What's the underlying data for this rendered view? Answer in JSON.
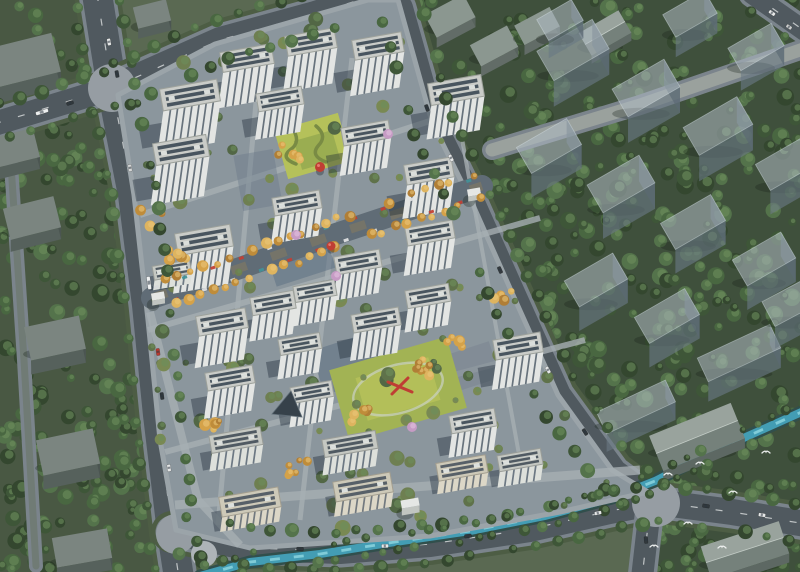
{
  "canvas": {
    "w": 800,
    "h": 572
  },
  "palette": {
    "ground_base": "#57654e",
    "forest": {
      "right": "#3b4b37",
      "left": "#45543e"
    },
    "road": {
      "verge": "#49593f",
      "bed": "#79828a",
      "asphalt": "#4c555b",
      "dash": "#e8eaea",
      "plaza": "#959ca2"
    },
    "canal": {
      "bank": "#2c4a47",
      "water": "#3f9cb3",
      "core": "#8fd8e2"
    },
    "compound": {
      "ground": "#8a949c",
      "edge": "#9ba3a8",
      "path": "#a6aeb2",
      "lawn": "#b6c156",
      "lawn2": "#8fa24a",
      "park": "#a2b250",
      "ring": "#ccd2c4",
      "axis": "#5d6973",
      "board": "#8a7a58"
    },
    "slab": {
      "t": {
        "roof": "#cbcdc8",
        "edge": "#9da09a",
        "panel": "#3a4651",
        "face": "#e5e7e4",
        "win": "#4e5b67"
      },
      "m": {
        "roof": "#c6c8c2",
        "edge": "#999c96",
        "panel": "#414c56",
        "face": "#dfe1dc",
        "win": "#566371"
      },
      "s": {
        "roof": "#cfc9b8",
        "edge": "#a39d8d",
        "panel": "#4a535c",
        "face": "#ded8c7",
        "win": "#5d6670"
      }
    },
    "ghost": {
      "top": "rgba(174,186,194,0.55)",
      "front": "rgba(104,118,129,0.62)",
      "side": "rgba(88,101,112,0.66)",
      "stroke": "rgba(218,228,233,0.45)"
    },
    "opaque": {
      "roof": "#79837d",
      "front": "#535d58",
      "side": "#47514c"
    },
    "flat": {
      "roof": "#8a958e",
      "front": "#5f6963",
      "side": "#555f59"
    },
    "pitched": {
      "light": "#98a29c",
      "dark": "#737e78",
      "front": "#5a645f"
    },
    "trees": {
      "green": [
        "#2f4229",
        "#3a5232",
        "#45633c",
        "#517046"
      ],
      "green_hi": "#6b8c59",
      "compound_green": [
        "#4f6340",
        "#5c6f45",
        "#6c7c4c",
        "#77874f"
      ],
      "orange": [
        "#c08a35",
        "#d7a144",
        "#e0b45b",
        "#b07b30"
      ],
      "orange_hi": "#ecc676",
      "pink": "#c79ac4",
      "pink_hi": "#e4c2e1"
    },
    "accents": {
      "red": "#c0392e",
      "white": "#f2f3f3",
      "teal": "#3e8f96"
    },
    "bird": "#f4f6f4",
    "shadow": "rgba(18,32,46,0.38)"
  },
  "forest_zones": [
    {
      "poly": [
        [
          393,
          0
        ],
        [
          800,
          0
        ],
        [
          800,
          572
        ],
        [
          652,
          572
        ],
        [
          648,
          512
        ],
        [
          612,
          470
        ],
        [
          556,
          392
        ],
        [
          512,
          292
        ],
        [
          470,
          200
        ],
        [
          430,
          118
        ]
      ],
      "n": 400,
      "rmin": 4,
      "rmax": 9,
      "seed": 11,
      "base": "right"
    },
    {
      "poly": [
        [
          0,
          0
        ],
        [
          96,
          0
        ],
        [
          112,
          88
        ],
        [
          133,
          195
        ],
        [
          147,
          305
        ],
        [
          158,
          415
        ],
        [
          172,
          532
        ],
        [
          178,
          572
        ],
        [
          0,
          572
        ]
      ],
      "n": 220,
      "rmin": 4,
      "rmax": 9,
      "seed": 7,
      "base": "left"
    }
  ],
  "roads": [
    {
      "id": "left-avenue",
      "pts": [
        [
          97,
          -6
        ],
        [
          112,
          88
        ],
        [
          133,
          195
        ],
        [
          147,
          305
        ],
        [
          158,
          415
        ],
        [
          172,
          532
        ],
        [
          179,
          578
        ]
      ],
      "w": 30,
      "verge": true,
      "dash": true
    },
    {
      "id": "west-arm",
      "pts": [
        [
          -6,
          124
        ],
        [
          112,
          88
        ]
      ],
      "w": 24,
      "verge": true,
      "dash": true
    },
    {
      "id": "north-east-ring",
      "pts": [
        [
          112,
          88
        ],
        [
          220,
          40
        ],
        [
          315,
          14
        ],
        [
          372,
          -4
        ],
        [
          400,
          8
        ],
        [
          432,
          122
        ],
        [
          473,
          205
        ],
        [
          513,
          295
        ],
        [
          558,
          395
        ],
        [
          614,
          472
        ],
        [
          652,
          500
        ]
      ],
      "w": 26,
      "verge": true,
      "dash": true
    },
    {
      "id": "south-road",
      "pts": [
        [
          172,
          532
        ],
        [
          250,
          548
        ],
        [
          340,
          551
        ],
        [
          430,
          544
        ],
        [
          530,
          529
        ],
        [
          610,
          511
        ],
        [
          656,
          502
        ],
        [
          732,
          512
        ],
        [
          806,
          524
        ]
      ],
      "w": 26,
      "verge": true,
      "dash": true
    },
    {
      "id": "south-exit",
      "pts": [
        [
          650,
          508
        ],
        [
          642,
          578
        ]
      ],
      "w": 22,
      "verge": false,
      "dash": true
    },
    {
      "id": "corner-road",
      "pts": [
        [
          752,
          -6
        ],
        [
          806,
          32
        ]
      ],
      "w": 20,
      "verge": false,
      "dash": true
    },
    {
      "id": "forest-path",
      "pts": [
        [
          492,
          150
        ],
        [
          640,
          105
        ],
        [
          806,
          48
        ]
      ],
      "w": 13,
      "verge": false,
      "dash": false,
      "color": "#9aa09c"
    },
    {
      "id": "far-left-lane",
      "pts": [
        [
          10,
          150
        ],
        [
          24,
          360
        ],
        [
          36,
          566
        ]
      ],
      "w": 7,
      "verge": false,
      "dash": false,
      "color": "#6e7872"
    }
  ],
  "tree_lines": [
    {
      "road": 0,
      "offsets": [
        -23,
        23
      ],
      "step": 21
    },
    {
      "road": 1,
      "offsets": [
        -18,
        18
      ],
      "step": 22
    },
    {
      "road": 2,
      "offsets": [
        -21,
        21
      ],
      "step": 22
    },
    {
      "road": 3,
      "offsets": [
        -19,
        19
      ],
      "step": 22
    },
    {
      "road": 5,
      "offsets": [
        16
      ],
      "step": 20
    }
  ],
  "intersections": [
    [
      112,
      88,
      24
    ],
    [
      176,
      534,
      20
    ],
    [
      656,
      503,
      24
    ]
  ],
  "corner_plaza": [
    204,
    554,
    13
  ],
  "canal": {
    "pts": [
      [
        200,
        576
      ],
      [
        250,
        562
      ],
      [
        320,
        554
      ],
      [
        395,
        542
      ],
      [
        470,
        531
      ],
      [
        545,
        516
      ],
      [
        612,
        498
      ],
      [
        655,
        481
      ],
      [
        700,
        458
      ],
      [
        748,
        436
      ],
      [
        806,
        410
      ]
    ],
    "w": 8,
    "tree_offsets": [
      -8,
      9
    ],
    "step": 16
  },
  "compound": {
    "outline": [
      [
        118,
        95
      ],
      [
        215,
        44
      ],
      [
        312,
        16
      ],
      [
        368,
        0
      ],
      [
        398,
        0
      ],
      [
        432,
        122
      ],
      [
        473,
        205
      ],
      [
        513,
        295
      ],
      [
        558,
        395
      ],
      [
        612,
        470
      ],
      [
        648,
        492
      ],
      [
        560,
        512
      ],
      [
        430,
        536
      ],
      [
        250,
        548
      ],
      [
        176,
        530
      ],
      [
        160,
        440
      ],
      [
        148,
        320
      ],
      [
        134,
        195
      ]
    ],
    "scatter_n": 120,
    "seed": 23,
    "paths": [
      {
        "pts": [
          [
            150,
            312
          ],
          [
            198,
            500
          ],
          [
            240,
            545
          ]
        ],
        "w": 8
      },
      {
        "pts": [
          [
            175,
            505
          ],
          [
            640,
            470
          ]
        ],
        "w": 9
      },
      {
        "pts": [
          [
            140,
            215
          ],
          [
            470,
            108
          ]
        ],
        "w": 6
      },
      {
        "pts": [
          [
            148,
            330
          ],
          [
            540,
            218
          ]
        ],
        "w": 6
      },
      {
        "pts": [
          [
            165,
            452
          ],
          [
            585,
            340
          ]
        ],
        "w": 6
      },
      {
        "pts": [
          [
            258,
            80
          ],
          [
            218,
            525
          ]
        ],
        "w": 5
      },
      {
        "pts": [
          [
            352,
            58
          ],
          [
            300,
            520
          ]
        ],
        "w": 5
      },
      {
        "pts": [
          [
            455,
            100
          ],
          [
            520,
            460
          ]
        ],
        "w": 4
      }
    ],
    "plazas": [
      [
        300,
        258,
        62,
        40,
        -18,
        "rgba(86,106,126,0.50)"
      ],
      [
        352,
        362,
        72,
        46,
        -18,
        "rgba(80,100,122,0.45)"
      ],
      [
        468,
        368,
        56,
        38,
        -18,
        "rgba(118,128,140,0.50)"
      ],
      [
        258,
        180,
        40,
        56,
        -10,
        "rgba(100,116,132,0.40)"
      ]
    ],
    "lawn_north": [
      313,
      146,
      66,
      50,
      -16
    ],
    "park": [
      398,
      389,
      122,
      74,
      -16
    ]
  },
  "axis": {
    "pts": [
      [
        152,
        298
      ],
      [
        240,
        268
      ],
      [
        330,
        236
      ],
      [
        420,
        206
      ],
      [
        482,
        186
      ]
    ],
    "w": 22,
    "stall_step": 15,
    "stall_offsets": [
      -9,
      9
    ],
    "stall_colors": [
      "#d8dadb",
      "#c23b2e",
      "#3e8f96",
      "#e0e2e3",
      "#c23b2e"
    ],
    "tree_offsets": [
      -13,
      13
    ],
    "tree_step": 13
  },
  "buildings": {
    "towers": [
      [
        190,
        95,
        58,
        22,
        42,
        "t"
      ],
      [
        247,
        58,
        52,
        20,
        36,
        "t"
      ],
      [
        311,
        42,
        50,
        20,
        36,
        "t"
      ],
      [
        378,
        46,
        50,
        20,
        36,
        "t"
      ],
      [
        456,
        90,
        54,
        22,
        34,
        "t"
      ],
      [
        181,
        150,
        54,
        22,
        40,
        "t"
      ],
      [
        280,
        99,
        46,
        18,
        28,
        "t"
      ],
      [
        366,
        133,
        48,
        18,
        30,
        "t"
      ],
      [
        429,
        171,
        48,
        20,
        34,
        "t"
      ],
      [
        204,
        240,
        56,
        22,
        38,
        "t"
      ],
      [
        297,
        203,
        48,
        18,
        28,
        "t"
      ],
      [
        430,
        233,
        48,
        18,
        30,
        "t"
      ],
      [
        222,
        322,
        50,
        20,
        32,
        "t"
      ],
      [
        273,
        303,
        44,
        18,
        26,
        "t"
      ],
      [
        358,
        262,
        46,
        18,
        26,
        "t"
      ],
      [
        315,
        291,
        42,
        16,
        24,
        "t"
      ],
      [
        376,
        320,
        48,
        18,
        28,
        "t"
      ],
      [
        428,
        296,
        44,
        18,
        24,
        "t"
      ],
      [
        518,
        346,
        48,
        20,
        30,
        "t"
      ],
      [
        473,
        421,
        46,
        18,
        24,
        "t"
      ],
      [
        230,
        378,
        48,
        18,
        28,
        "t"
      ],
      [
        300,
        344,
        42,
        16,
        24,
        "t"
      ],
      [
        312,
        392,
        42,
        16,
        24,
        "t"
      ],
      [
        520,
        460,
        44,
        16,
        16,
        "m"
      ],
      [
        236,
        440,
        52,
        18,
        18,
        "m"
      ],
      [
        350,
        444,
        54,
        18,
        18,
        "m"
      ],
      [
        172,
        270,
        38,
        14,
        10,
        "m"
      ],
      [
        250,
        502,
        60,
        20,
        15,
        "s"
      ],
      [
        363,
        487,
        58,
        20,
        15,
        "s"
      ],
      [
        462,
        468,
        50,
        18,
        13,
        "s"
      ]
    ],
    "ghosts": [
      [
        573,
        50,
        64,
        34,
        -30,
        26
      ],
      [
        646,
        88,
        60,
        32,
        -30,
        26
      ],
      [
        718,
        126,
        62,
        32,
        -30,
        26
      ],
      [
        788,
        163,
        58,
        30,
        -30,
        24
      ],
      [
        549,
        146,
        58,
        30,
        -30,
        24
      ],
      [
        621,
        184,
        60,
        32,
        -30,
        26
      ],
      [
        693,
        222,
        58,
        30,
        -30,
        24
      ],
      [
        764,
        259,
        56,
        30,
        -30,
        24
      ],
      [
        596,
        280,
        56,
        30,
        -30,
        24
      ],
      [
        667,
        316,
        58,
        30,
        -30,
        24
      ],
      [
        739,
        353,
        80,
        26,
        -25,
        20
      ],
      [
        795,
        300,
        60,
        28,
        -28,
        22
      ],
      [
        636,
        407,
        76,
        24,
        -25,
        18
      ],
      [
        560,
        20,
        40,
        24,
        -30,
        18
      ],
      [
        690,
        14,
        48,
        26,
        -30,
        20
      ],
      [
        756,
        47,
        50,
        26,
        -30,
        20
      ]
    ],
    "left_blocks": [
      [
        25,
        60,
        64,
        40,
        -14,
        16
      ],
      [
        14,
        148,
        46,
        30,
        -14,
        12
      ],
      [
        32,
        218,
        52,
        32,
        -14,
        12
      ],
      [
        55,
        338,
        56,
        34,
        -12,
        14
      ],
      [
        68,
        452,
        58,
        36,
        -12,
        14
      ],
      [
        82,
        548,
        56,
        30,
        -10,
        12
      ],
      [
        152,
        14,
        34,
        22,
        -14,
        10
      ]
    ],
    "flats": [
      [
        450,
        16,
        44,
        26,
        -28,
        10
      ],
      [
        494,
        46,
        42,
        24,
        -28,
        10
      ],
      [
        537,
        26,
        40,
        22,
        -28,
        10
      ]
    ],
    "pitched": [
      [
        697,
        437,
        88,
        38,
        -22,
        10
      ],
      [
        745,
        550,
        82,
        34,
        -18,
        9
      ],
      [
        605,
        33,
        46,
        26,
        -30,
        8
      ]
    ],
    "gates": [
      [
        410,
        503,
        18,
        8,
        7
      ],
      [
        158,
        296,
        13,
        7,
        5
      ],
      [
        474,
        192,
        13,
        7,
        5
      ]
    ],
    "pavilion": [
      [
        272,
        414
      ],
      [
        302,
        417
      ],
      [
        291,
        391
      ]
    ]
  },
  "orange_clusters": [
    [
      178,
      258,
      7
    ],
    [
      288,
      152,
      5
    ],
    [
      300,
      467,
      6
    ],
    [
      422,
      368,
      8
    ],
    [
      362,
      418,
      5
    ],
    [
      452,
      340,
      4
    ],
    [
      502,
      300,
      4
    ],
    [
      210,
      430,
      5
    ],
    [
      152,
      218,
      3
    ]
  ],
  "pink_trees": [
    [
      388,
      134
    ],
    [
      336,
      276
    ],
    [
      412,
      427
    ],
    [
      296,
      235
    ]
  ],
  "red_balls": [
    [
      320,
      167,
      5
    ],
    [
      331,
      246,
      4.5
    ]
  ],
  "x_sculpture": [
    400,
    386
  ],
  "lawn_squiggle": "M292,128 q10,14 -2,22 q-10,8 6,14 M316,126 q12,10 2,20 q-8,10 8,16",
  "vehicles": [
    [
      109,
      42,
      80,
      7,
      "#e9eaea"
    ],
    [
      117,
      74,
      80,
      7,
      "#2c3237"
    ],
    [
      130,
      168,
      81,
      7,
      "#d7d8d8"
    ],
    [
      149,
      283,
      82,
      13,
      "#f2f3f3"
    ],
    [
      158,
      352,
      82,
      7,
      "#b8352b"
    ],
    [
      162,
      396,
      82,
      7,
      "#2c3237"
    ],
    [
      169,
      468,
      82,
      7,
      "#e9eaea"
    ],
    [
      427,
      108,
      70,
      7,
      "#2c3237"
    ],
    [
      451,
      158,
      64,
      7,
      "#e9eaea"
    ],
    [
      500,
      270,
      66,
      7,
      "#30363b"
    ],
    [
      548,
      370,
      62,
      7,
      "#e9eaea"
    ],
    [
      585,
      432,
      57,
      7,
      "#2c3237"
    ],
    [
      300,
      549,
      2,
      7,
      "#2c3237"
    ],
    [
      385,
      546,
      -2,
      7,
      "#e9eaea"
    ],
    [
      468,
      536,
      -7,
      7,
      "#2c3237"
    ],
    [
      598,
      513,
      -11,
      7,
      "#e9eaea"
    ],
    [
      706,
      506,
      9,
      7,
      "#2c3237"
    ],
    [
      762,
      515,
      9,
      7,
      "#e9eaea"
    ],
    [
      646,
      540,
      85,
      7,
      "#2c3237"
    ],
    [
      772,
      13,
      35,
      7,
      "#e9eaea"
    ],
    [
      789,
      27,
      35,
      6,
      "#cfd0d0"
    ],
    [
      42,
      112,
      -17,
      13,
      "#f0f1f1"
    ],
    [
      70,
      103,
      -17,
      7,
      "#2c3237"
    ]
  ],
  "birds": [
    [
      668,
      474
    ],
    [
      700,
      463
    ],
    [
      733,
      492
    ],
    [
      688,
      523
    ],
    [
      654,
      546
    ],
    [
      722,
      547
    ],
    [
      766,
      452
    ]
  ]
}
